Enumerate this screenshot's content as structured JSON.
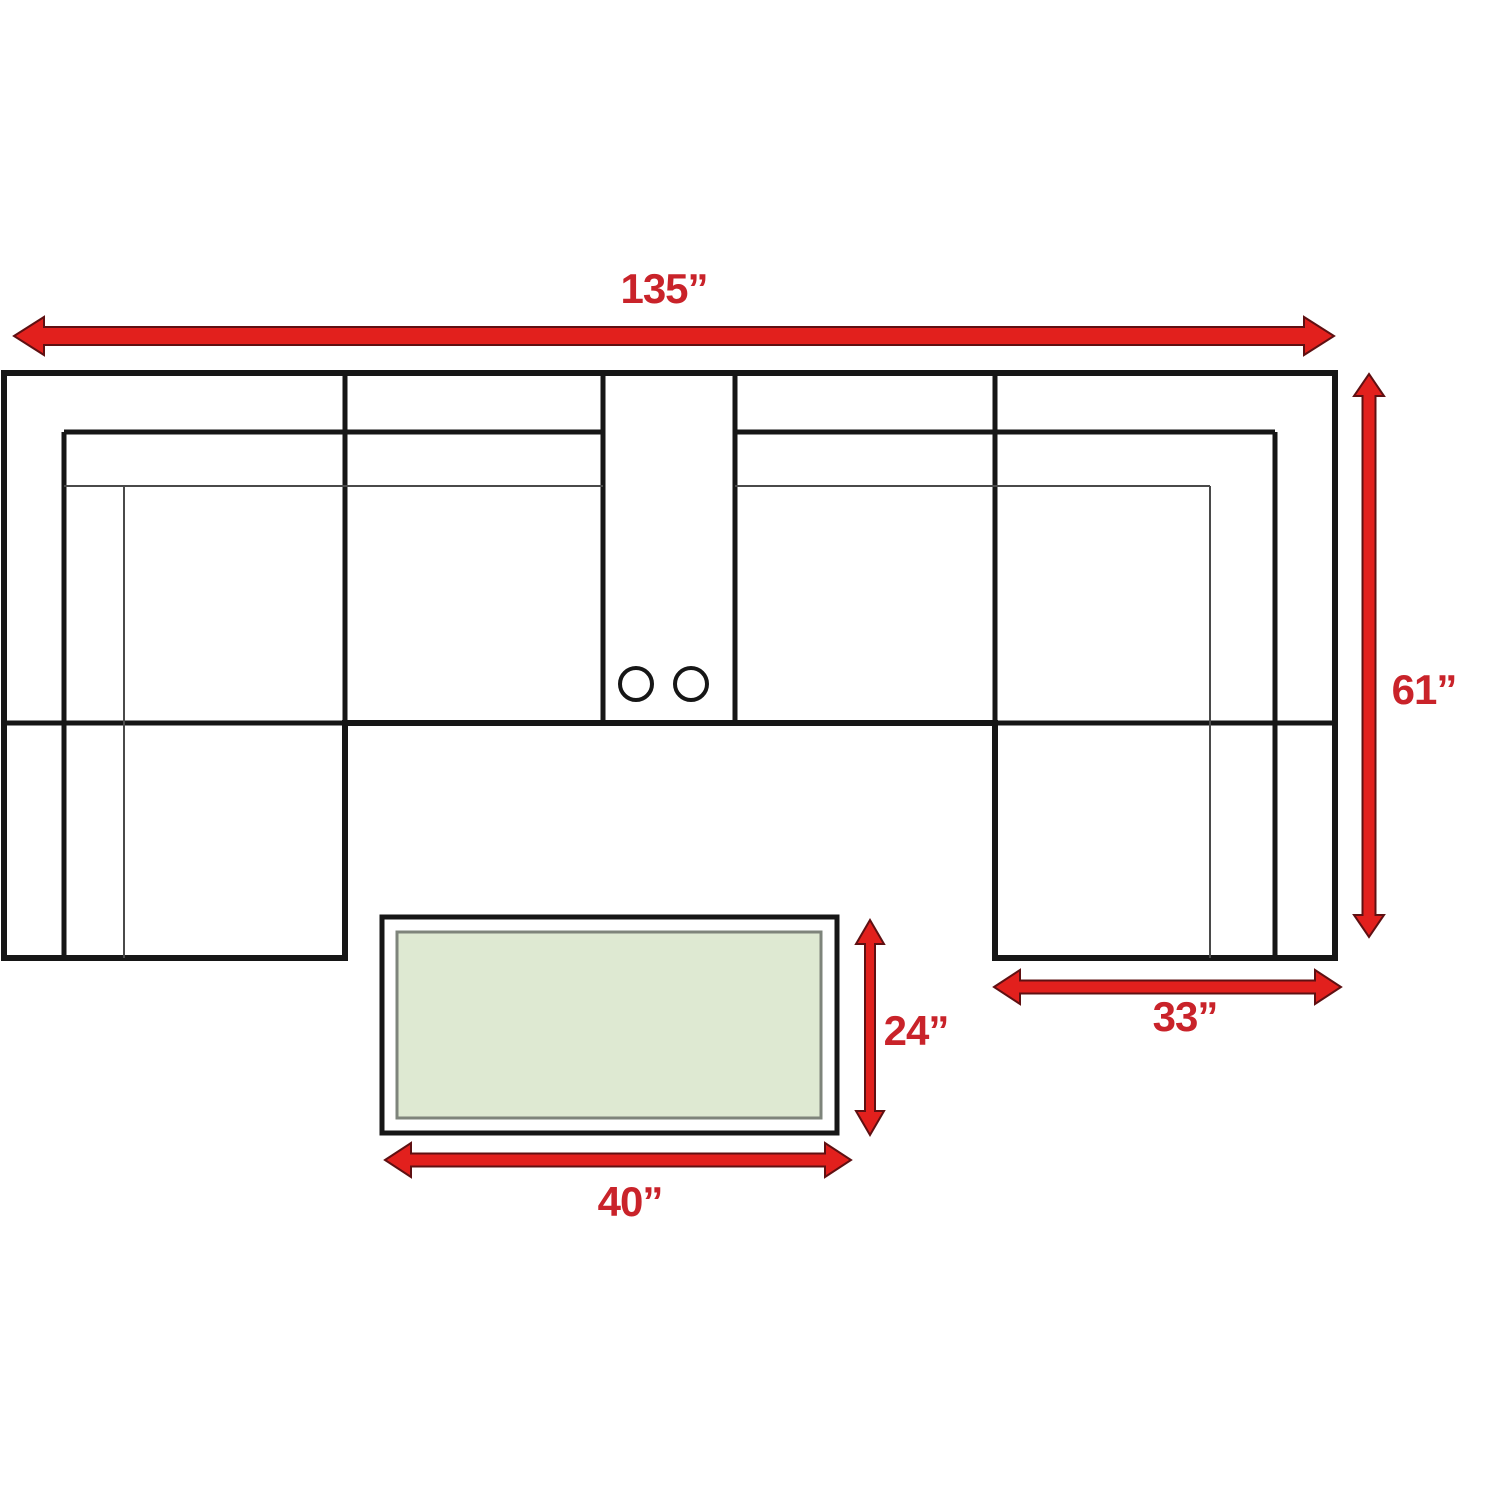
{
  "page": {
    "title": "Sectional sofa with coffee table — top-view dimension diagram"
  },
  "colors": {
    "canvas-bg": "#ffffff",
    "line-strong": "#161616",
    "line-light": "#4a4a4a",
    "arrow-fill": "#e2201d",
    "arrow-outline": "#5f1012",
    "dimension-text": "#c9232a",
    "table-top-fill": "#dee9d2",
    "table-inner-border": "#7e847b",
    "sofa-fill": "#ffffff"
  },
  "dimensions": {
    "overall_width": {
      "label": "135”",
      "inches": 135
    },
    "overall_depth": {
      "label": "61”",
      "inches": 61
    },
    "chaise_width": {
      "label": "33”",
      "inches": 33
    },
    "table_depth": {
      "label": "24”",
      "inches": 24
    },
    "table_width": {
      "label": "40”",
      "inches": 40
    }
  },
  "parts": {
    "sofa": "U-shaped sectional sofa, top view, dual chaises",
    "console": {
      "cup_holder_count": 2
    },
    "table": "rectangular coffee table, top view"
  }
}
